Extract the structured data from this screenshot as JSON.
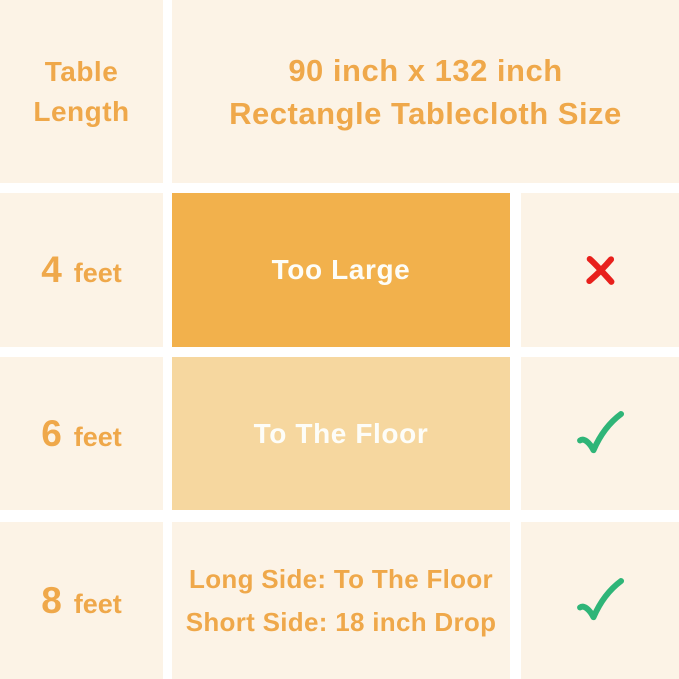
{
  "colors": {
    "canvas": "#ffffff",
    "cell_background": "#FCF3E6",
    "accent_text": "#EFA84A",
    "fit_box_solid": "#F2B14C",
    "fit_box_light": "#F6D79F",
    "fit_box_text": "#FDFDF8",
    "cross": "#E8201C",
    "check": "#2FB578"
  },
  "header": {
    "row_header_line1": "Table",
    "row_header_line2": "Length",
    "title_line1": "90 inch x 132 inch",
    "title_line2": "Rectangle Tablecloth Size"
  },
  "rows": [
    {
      "length_value": "4",
      "length_unit": "feet",
      "fit_label": "Too Large",
      "verdict": "not-suitable",
      "verdict_icon": "cross-icon"
    },
    {
      "length_value": "6",
      "length_unit": "feet",
      "fit_label": "To The Floor",
      "verdict": "suitable",
      "verdict_icon": "check-icon"
    },
    {
      "length_value": "8",
      "length_unit": "feet",
      "fit_label_line1": "Long Side: To The Floor",
      "fit_label_line2": "Short Side: 18 inch Drop",
      "verdict": "suitable",
      "verdict_icon": "check-icon"
    }
  ],
  "chart_data": {
    "type": "table",
    "title": "90 inch x 132 inch Rectangle Tablecloth Size",
    "columns": [
      "Table Length",
      "Fit Result",
      "Suitable"
    ],
    "rows": [
      [
        "4 feet",
        "Too Large",
        "no"
      ],
      [
        "6 feet",
        "To The Floor",
        "yes"
      ],
      [
        "8 feet",
        "Long Side: To The Floor; Short Side: 18 inch Drop",
        "yes"
      ]
    ]
  }
}
